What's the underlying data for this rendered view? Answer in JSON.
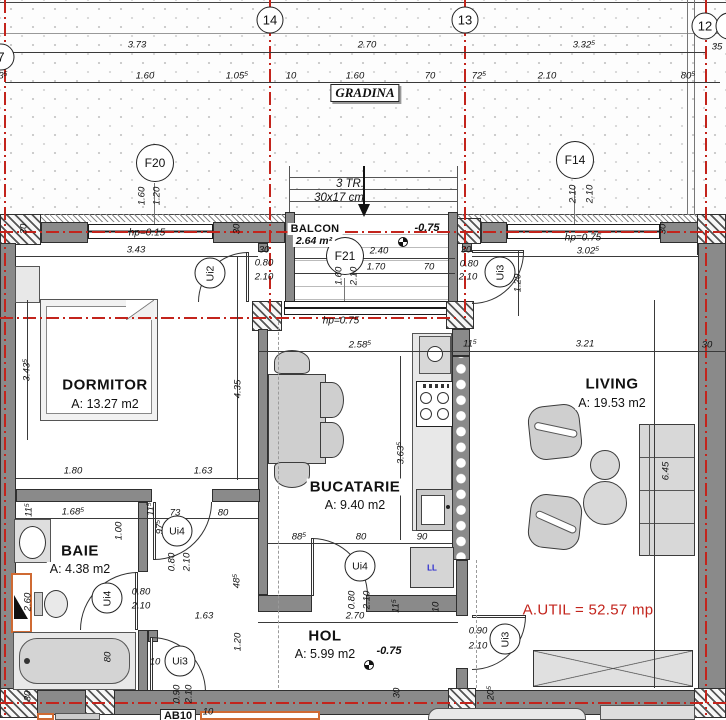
{
  "meta": {
    "drawing_type": "apartment floor plan",
    "total_area_label": "A.UTIL = 52.57 mp"
  },
  "colors": {
    "red": "#c3241c",
    "blue": "#2323cf",
    "orange": "#cf6a33",
    "wall": "#8a8a8a"
  },
  "grid_bubbles": [
    {
      "t": "7",
      "x": 1,
      "y": 57
    },
    {
      "t": "14",
      "x": 270,
      "y": 20
    },
    {
      "t": "13",
      "x": 465,
      "y": 20
    },
    {
      "t": "12",
      "x": 705,
      "y": 26
    },
    {
      "t": "",
      "x": 729,
      "y": 26
    }
  ],
  "window_tags": [
    {
      "t": "F20",
      "x": 155,
      "y": 163
    },
    {
      "t": "F14",
      "x": 575,
      "y": 160
    },
    {
      "t": "F21",
      "x": 345,
      "y": 256
    }
  ],
  "door_tags": [
    {
      "t": "Ui2",
      "x": 210,
      "y": 273,
      "v": 1
    },
    {
      "t": "Ui3",
      "x": 500,
      "y": 272,
      "v": 1
    },
    {
      "t": "Ui4",
      "x": 177,
      "y": 531,
      "v": 0
    },
    {
      "t": "Ui4",
      "x": 107,
      "y": 598,
      "v": 1
    },
    {
      "t": "Ui4",
      "x": 360,
      "y": 566,
      "v": 0
    },
    {
      "t": "Ui3",
      "x": 180,
      "y": 661,
      "v": 0
    },
    {
      "t": "Ui3",
      "x": 505,
      "y": 639,
      "v": 1
    }
  ],
  "rooms": [
    {
      "name": "DORMITOR",
      "area": "A: 13.27 m2",
      "nx": 105,
      "ny": 385,
      "ax": 105,
      "ay": 404,
      "sm": 0
    },
    {
      "name": "BAIE",
      "area": "A: 4.38 m2",
      "nx": 80,
      "ny": 551,
      "ax": 80,
      "ay": 569,
      "sm": 0
    },
    {
      "name": "BUCATARIE",
      "area": "A: 9.40 m2",
      "nx": 355,
      "ny": 487,
      "ax": 355,
      "ay": 505,
      "sm": 0
    },
    {
      "name": "HOL",
      "area": "A: 5.99 m2",
      "nx": 325,
      "ny": 636,
      "ax": 325,
      "ay": 654,
      "sm": 0
    },
    {
      "name": "LIVING",
      "area": "A: 19.53 m2",
      "nx": 612,
      "ny": 384,
      "ax": 612,
      "ay": 403,
      "sm": 0
    },
    {
      "name": "BALCON",
      "area": "2.64 m²",
      "nx": 315,
      "ny": 229,
      "ax": 314,
      "ay": 241,
      "sm": 1
    }
  ],
  "notes": [
    {
      "t": "GRADINA",
      "x": 365,
      "y": 93,
      "cls": "gradina"
    },
    {
      "t": "3 TR.",
      "x": 350,
      "y": 184,
      "cls": "stair"
    },
    {
      "t": "30x17 cm",
      "x": 339,
      "y": 198,
      "cls": "stair"
    },
    {
      "t": "A.UTIL = 52.57 mp",
      "x": 588,
      "y": 610,
      "cls": "autil"
    },
    {
      "t": "-0.75",
      "x": 427,
      "y": 228,
      "cls": "level"
    },
    {
      "t": "-0.75",
      "x": 389,
      "y": 651,
      "cls": "level"
    },
    {
      "t": "hp=0.15",
      "x": 147,
      "y": 233,
      "cls": "hp"
    },
    {
      "t": "hp=0.75",
      "x": 583,
      "y": 238,
      "cls": "hp"
    },
    {
      "t": "hp=0.75",
      "x": 341,
      "y": 321,
      "cls": "hp"
    },
    {
      "t": "LL",
      "x": 432,
      "y": 568,
      "cls": "ll"
    },
    {
      "t": "AB10",
      "x": 178,
      "y": 716,
      "cls": "ab"
    }
  ],
  "dims_h": [
    {
      "t": "3.73",
      "x": 137,
      "y": 45
    },
    {
      "t": "2.70",
      "x": 367,
      "y": 45
    },
    {
      "t": "3.32⁵",
      "x": 584,
      "y": 45
    },
    {
      "t": "35",
      "x": 717,
      "y": 47
    },
    {
      "t": "3⁵",
      "x": 3,
      "y": 76
    },
    {
      "t": "1.60",
      "x": 145,
      "y": 76
    },
    {
      "t": "1.05⁵",
      "x": 237,
      "y": 76
    },
    {
      "t": "10",
      "x": 291,
      "y": 76
    },
    {
      "t": "1.60",
      "x": 355,
      "y": 76
    },
    {
      "t": "70",
      "x": 430,
      "y": 76
    },
    {
      "t": "72⁵",
      "x": 479,
      "y": 76
    },
    {
      "t": "2.10",
      "x": 547,
      "y": 76
    },
    {
      "t": "80⁵",
      "x": 688,
      "y": 76
    },
    {
      "t": "3.43",
      "x": 136,
      "y": 250
    },
    {
      "t": "2.40",
      "x": 379,
      "y": 251
    },
    {
      "t": "1.70",
      "x": 376,
      "y": 267
    },
    {
      "t": "70",
      "x": 429,
      "y": 267
    },
    {
      "t": "30",
      "x": 264,
      "y": 250
    },
    {
      "t": "0.80",
      "x": 264,
      "y": 263
    },
    {
      "t": "2.10",
      "x": 264,
      "y": 277
    },
    {
      "t": "30",
      "x": 466,
      "y": 250
    },
    {
      "t": "0.80",
      "x": 469,
      "y": 264
    },
    {
      "t": "2.10",
      "x": 468,
      "y": 277
    },
    {
      "t": "3.02⁵",
      "x": 588,
      "y": 251
    },
    {
      "t": "2.58⁵",
      "x": 360,
      "y": 345
    },
    {
      "t": "11⁵",
      "x": 470,
      "y": 344
    },
    {
      "t": "3.21",
      "x": 585,
      "y": 344
    },
    {
      "t": "30",
      "x": 707,
      "y": 345
    },
    {
      "t": "1.80",
      "x": 73,
      "y": 471
    },
    {
      "t": "1.63",
      "x": 203,
      "y": 471
    },
    {
      "t": "1.68⁵",
      "x": 73,
      "y": 512
    },
    {
      "t": "73",
      "x": 175,
      "y": 513
    },
    {
      "t": "80",
      "x": 223,
      "y": 513
    },
    {
      "t": "0.80",
      "x": 141,
      "y": 592
    },
    {
      "t": "2.10",
      "x": 141,
      "y": 606
    },
    {
      "t": "88⁵",
      "x": 299,
      "y": 537
    },
    {
      "t": "80",
      "x": 361,
      "y": 537
    },
    {
      "t": "90",
      "x": 422,
      "y": 537
    },
    {
      "t": "1.63",
      "x": 204,
      "y": 616
    },
    {
      "t": "2.70",
      "x": 355,
      "y": 616
    },
    {
      "t": "0.90",
      "x": 478,
      "y": 631
    },
    {
      "t": "2.10",
      "x": 478,
      "y": 646
    },
    {
      "t": "10",
      "x": 155,
      "y": 662
    },
    {
      "t": "10",
      "x": 208,
      "y": 712
    }
  ],
  "dims_v": [
    {
      "t": "1.60",
      "x": 142,
      "y": 196
    },
    {
      "t": "1.20",
      "x": 157,
      "y": 196
    },
    {
      "t": "2.10",
      "x": 573,
      "y": 194
    },
    {
      "t": "2.10",
      "x": 590,
      "y": 194
    },
    {
      "t": "1.60",
      "x": 339,
      "y": 276
    },
    {
      "t": "2.10",
      "x": 354,
      "y": 276
    },
    {
      "t": "30",
      "x": 24,
      "y": 229
    },
    {
      "t": "30",
      "x": 237,
      "y": 229
    },
    {
      "t": "30",
      "x": 663,
      "y": 229
    },
    {
      "t": "3.43⁵",
      "x": 27,
      "y": 370
    },
    {
      "t": "4.35",
      "x": 238,
      "y": 389
    },
    {
      "t": "3.63⁵",
      "x": 401,
      "y": 453
    },
    {
      "t": "1.20",
      "x": 518,
      "y": 283
    },
    {
      "t": "11⁵",
      "x": 29,
      "y": 510
    },
    {
      "t": "11⁵",
      "x": 151,
      "y": 509
    },
    {
      "t": "97⁵",
      "x": 160,
      "y": 527
    },
    {
      "t": "1.00",
      "x": 119,
      "y": 531
    },
    {
      "t": "0.80",
      "x": 172,
      "y": 562
    },
    {
      "t": "2.10",
      "x": 187,
      "y": 562
    },
    {
      "t": "2.60",
      "x": 28,
      "y": 602
    },
    {
      "t": "48⁵",
      "x": 237,
      "y": 581
    },
    {
      "t": "1.20",
      "x": 238,
      "y": 642
    },
    {
      "t": "80",
      "x": 108,
      "y": 657
    },
    {
      "t": "6.45",
      "x": 666,
      "y": 471
    },
    {
      "t": "0.80",
      "x": 352,
      "y": 600
    },
    {
      "t": "2.10",
      "x": 367,
      "y": 600
    },
    {
      "t": "11⁵",
      "x": 396,
      "y": 606
    },
    {
      "t": "10",
      "x": 436,
      "y": 607
    },
    {
      "t": "0.90",
      "x": 177,
      "y": 694
    },
    {
      "t": "2.10",
      "x": 189,
      "y": 694
    },
    {
      "t": "30",
      "x": 28,
      "y": 696
    },
    {
      "t": "30",
      "x": 397,
      "y": 693
    },
    {
      "t": "20⁵",
      "x": 491,
      "y": 693
    }
  ]
}
